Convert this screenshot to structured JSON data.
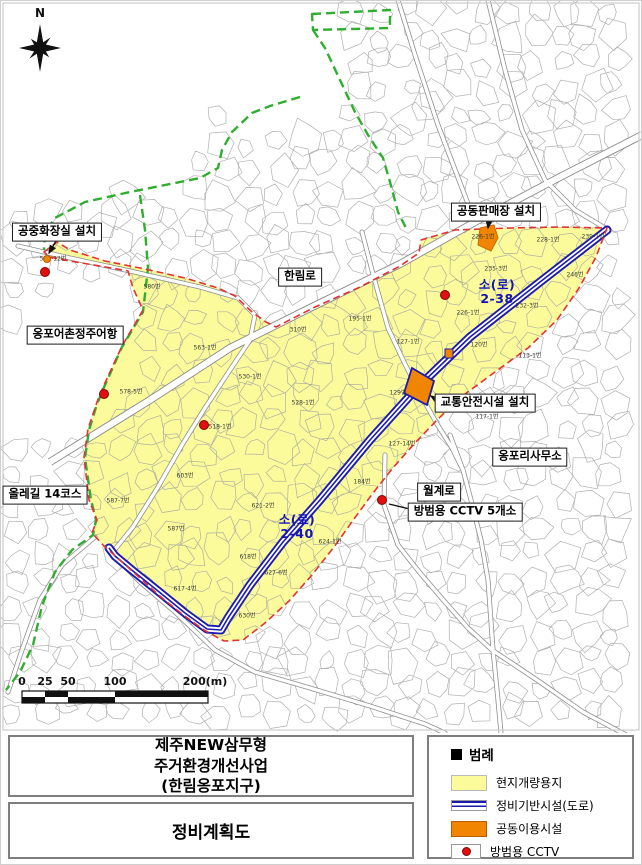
{
  "map": {
    "compass_label": "N",
    "labels": [
      {
        "id": "public-toilet",
        "text": "공중화장실 설치"
      },
      {
        "id": "joint-market",
        "text": "공동판매장 설치"
      },
      {
        "id": "hallim-ro",
        "text": "한림로"
      },
      {
        "id": "ongpo-fishing-port",
        "text": "옹포어촌정주어항"
      },
      {
        "id": "traffic-safety",
        "text": "교통안전시설 설치"
      },
      {
        "id": "ongpo-ri-office",
        "text": "옹포리사무소"
      },
      {
        "id": "olle-trail",
        "text": "올레길 14코스"
      },
      {
        "id": "wolgye-ro",
        "text": "월계로"
      },
      {
        "id": "cctv-five",
        "text": "방범용 CCTV 5개소"
      }
    ],
    "road_labels": [
      {
        "text": "소(로)\n2-38"
      },
      {
        "text": "소(로)\n2-40"
      }
    ],
    "parcels": [
      {
        "t": "550-12번",
        "x": 53,
        "y": 258
      },
      {
        "t": "580번",
        "x": 152,
        "y": 286
      },
      {
        "t": "563-1번",
        "x": 205,
        "y": 347
      },
      {
        "t": "578-5번",
        "x": 131,
        "y": 391
      },
      {
        "t": "530-1번",
        "x": 250,
        "y": 376
      },
      {
        "t": "528-1번",
        "x": 303,
        "y": 402
      },
      {
        "t": "518-1번",
        "x": 220,
        "y": 426
      },
      {
        "t": "195-1번",
        "x": 360,
        "y": 318
      },
      {
        "t": "310번",
        "x": 298,
        "y": 329
      },
      {
        "t": "226-1번",
        "x": 483,
        "y": 236
      },
      {
        "t": "239-1번",
        "x": 593,
        "y": 236
      },
      {
        "t": "228-1번",
        "x": 548,
        "y": 239
      },
      {
        "t": "235-3번",
        "x": 496,
        "y": 268
      },
      {
        "t": "246번",
        "x": 575,
        "y": 274
      },
      {
        "t": "232-3번",
        "x": 527,
        "y": 305
      },
      {
        "t": "226-1번",
        "x": 468,
        "y": 312
      },
      {
        "t": "127-1번",
        "x": 408,
        "y": 341
      },
      {
        "t": "120번",
        "x": 479,
        "y": 344
      },
      {
        "t": "113-1번",
        "x": 530,
        "y": 355
      },
      {
        "t": "129번",
        "x": 398,
        "y": 392
      },
      {
        "t": "117-1번",
        "x": 487,
        "y": 416
      },
      {
        "t": "127-14번",
        "x": 402,
        "y": 443
      },
      {
        "t": "184번",
        "x": 362,
        "y": 481
      },
      {
        "t": "603번",
        "x": 185,
        "y": 475
      },
      {
        "t": "587-7번",
        "x": 118,
        "y": 500
      },
      {
        "t": "587번",
        "x": 176,
        "y": 528
      },
      {
        "t": "621-2번",
        "x": 263,
        "y": 505
      },
      {
        "t": "624-1번",
        "x": 330,
        "y": 541
      },
      {
        "t": "618번",
        "x": 248,
        "y": 556
      },
      {
        "t": "627-6번",
        "x": 276,
        "y": 572
      },
      {
        "t": "617-4번",
        "x": 185,
        "y": 588
      },
      {
        "t": "630번",
        "x": 247,
        "y": 615
      }
    ],
    "cctv_dots": [
      {
        "x": 45,
        "y": 272
      },
      {
        "x": 104,
        "y": 394
      },
      {
        "x": 204,
        "y": 425
      },
      {
        "x": 445,
        "y": 295
      },
      {
        "x": 382,
        "y": 500
      }
    ]
  },
  "scale": {
    "labels": [
      {
        "t": "0",
        "x": 22,
        "y": 688
      },
      {
        "t": "25",
        "x": 45,
        "y": 688
      },
      {
        "t": "50",
        "x": 68,
        "y": 688
      },
      {
        "t": "100",
        "x": 115,
        "y": 688
      },
      {
        "t": "200(m)",
        "x": 205,
        "y": 688
      }
    ]
  },
  "title_block": {
    "line1": "제주NEW삼무형",
    "line2": "주거환경개선사업",
    "line3": "(한림옹포지구)",
    "subtitle": "정비계획도"
  },
  "legend": {
    "header": "범례",
    "items": [
      {
        "label": "현지개량용지",
        "color": "#FBFB9B"
      },
      {
        "label": "정비기반시설(도로)",
        "color": "#1B1BB0"
      },
      {
        "label": "공동이용시설",
        "color": "#F28500"
      },
      {
        "label": "방범용 CCTV",
        "color": "#E01010"
      }
    ]
  },
  "colors": {
    "improvement_area": "#FBFB9B",
    "road_infrastructure": "#1B1BB0",
    "community_facility": "#F28500",
    "cctv": "#E01010",
    "area_boundary": "#E23333",
    "olle_trail": "#2FAE2F"
  }
}
